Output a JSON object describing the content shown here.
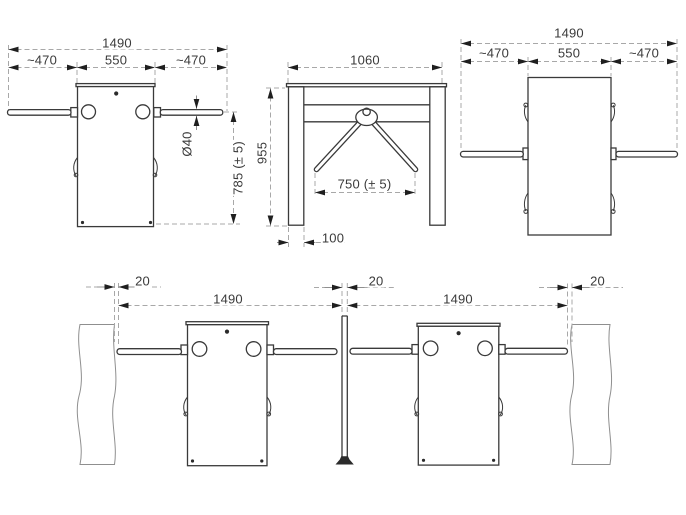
{
  "drawing": {
    "type": "tripod turnstile dimensional / installation drawing",
    "views": {
      "top_view_left": {
        "dim_total_width": "1490",
        "dim_left_arm": "~470",
        "dim_cabinet_width": "550",
        "dim_right_arm": "~470",
        "dim_arm_diameter": "Ø40",
        "dim_arm_height": "785 (± 5)"
      },
      "front_view": {
        "dim_width": "1060",
        "dim_height": "955",
        "dim_rotor_span": "750 (± 5)",
        "dim_leg_width": "100"
      },
      "top_view_right": {
        "dim_total_width": "1490",
        "dim_left_arm": "~470",
        "dim_cabinet_width": "550",
        "dim_right_arm": "~470"
      },
      "installation_view": {
        "dim_wall_gap_left": "20",
        "dim_lane_left": "1490",
        "dim_post_gap": "20",
        "dim_lane_right": "1490",
        "dim_wall_gap_right": "20"
      }
    }
  }
}
